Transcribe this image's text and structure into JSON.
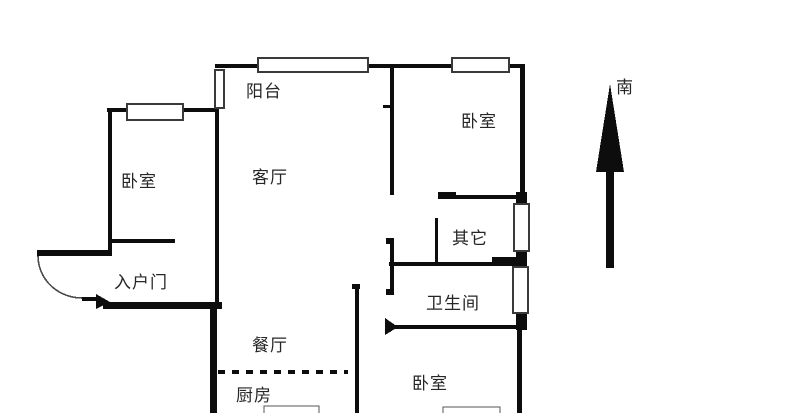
{
  "labels": {
    "balcony": "阳台",
    "bedroom_top_left": "卧室",
    "living_room": "客厅",
    "bedroom_top_right": "卧室",
    "other": "其它",
    "entrance_door": "入户门",
    "bathroom": "卫生间",
    "dining_room": "餐厅",
    "kitchen": "厨房",
    "bedroom_bottom_right": "卧室",
    "compass_south": "南"
  },
  "colors": {
    "background": "#ffffff",
    "wall": "#0d0d0d",
    "window_border": "#3a3a3a",
    "window_fill": "#ffffff",
    "furniture_border": "#555555",
    "door_arc": "#4a4a4a",
    "text": "#262626"
  },
  "floorplan": {
    "walls": [
      [
        215,
        64,
        310,
        4
      ],
      [
        520,
        64,
        5,
        141
      ],
      [
        516,
        192,
        11,
        13
      ],
      [
        516,
        251,
        11,
        16
      ],
      [
        516,
        313,
        11,
        17
      ],
      [
        517,
        330,
        5,
        83
      ],
      [
        107,
        108,
        110,
        4
      ],
      [
        108,
        108,
        4,
        148
      ],
      [
        110,
        239,
        65,
        4
      ],
      [
        37,
        250,
        75,
        6
      ],
      [
        103,
        302,
        119,
        7
      ],
      [
        215,
        108,
        4,
        195
      ],
      [
        210,
        303,
        7,
        110
      ],
      [
        390,
        64,
        4,
        131
      ],
      [
        383,
        105,
        8,
        3
      ],
      [
        438,
        195,
        87,
        4
      ],
      [
        438,
        192,
        18,
        7
      ],
      [
        435,
        218,
        3,
        45
      ],
      [
        389,
        262,
        134,
        4
      ],
      [
        492,
        257,
        26,
        6
      ],
      [
        390,
        238,
        4,
        57
      ],
      [
        386,
        238,
        8,
        6
      ],
      [
        386,
        289,
        8,
        6
      ],
      [
        388,
        325,
        135,
        4
      ],
      [
        355,
        285,
        4,
        128
      ],
      [
        352,
        284,
        8,
        5
      ]
    ],
    "windows": [
      [
        258,
        58,
        110,
        14
      ],
      [
        452,
        58,
        57,
        14
      ],
      [
        514,
        204,
        15,
        47
      ],
      [
        513,
        267,
        15,
        46
      ],
      [
        127,
        104,
        56,
        16
      ],
      [
        215,
        70,
        9,
        38
      ]
    ],
    "furniture": [
      [
        264,
        406,
        55,
        12
      ],
      [
        443,
        407,
        57,
        10
      ]
    ],
    "solid_marks": [
      "385,318 398,327 385,335",
      "96,294 110,302 96,309"
    ],
    "dashed_divider": {
      "x1": 218,
      "x2": 348,
      "y": 370,
      "thickness": 4,
      "dash": 7,
      "gap": 7
    },
    "entry_door": {
      "arc_path": "M 38 256 A 44 42 0 0 0 82 298",
      "leaf": [
        82,
        297,
        17,
        4
      ]
    },
    "compass_arrow": {
      "shaft": [
        606,
        160,
        8,
        108
      ],
      "head_points": "610,84 596,172 624,172"
    }
  }
}
